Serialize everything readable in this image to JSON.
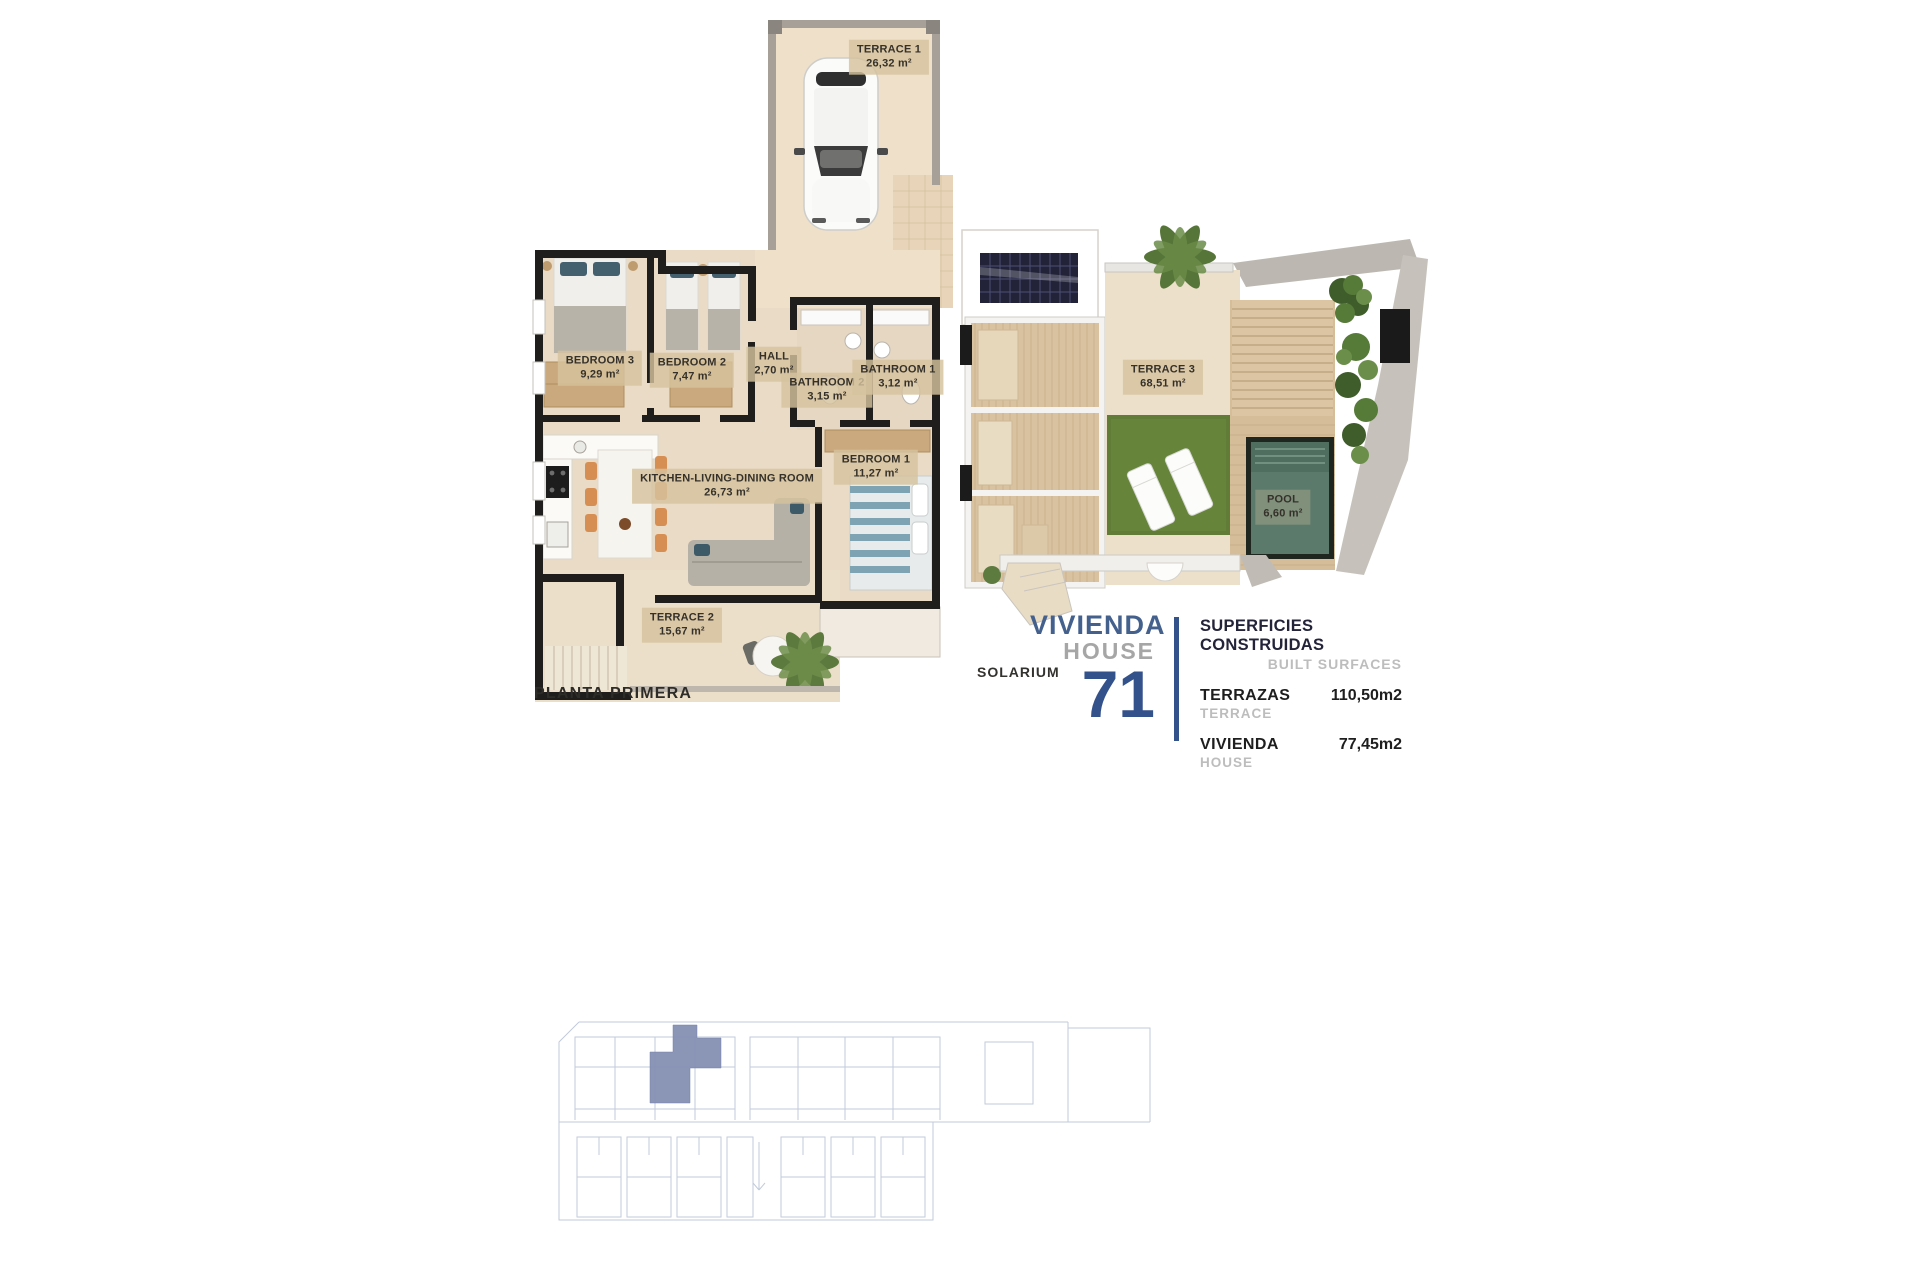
{
  "plan_left": {
    "title": "PLANTA PRIMERA",
    "rooms": [
      {
        "name": "TERRACE 1",
        "area": "26,32 m²"
      },
      {
        "name": "BEDROOM 3",
        "area": "9,29 m²"
      },
      {
        "name": "BEDROOM 2",
        "area": "7,47 m²"
      },
      {
        "name": "HALL",
        "area": "2,70  m²"
      },
      {
        "name": "BATHROOM 2",
        "area": "3,15 m²"
      },
      {
        "name": "BATHROOM 1",
        "area": "3,12 m²"
      },
      {
        "name": "BEDROOM 1",
        "area": "11,27 m²"
      },
      {
        "name": "KITCHEN-LIVING-DINING ROOM",
        "area": "26,73 m²"
      },
      {
        "name": "TERRACE 2",
        "area": "15,67 m²"
      }
    ]
  },
  "plan_right": {
    "title": "SOLARIUM",
    "rooms": [
      {
        "name": "TERRACE 3",
        "area": "68,51 m²"
      },
      {
        "name": "POOL",
        "area": "6,60 m²"
      }
    ]
  },
  "unit": {
    "vivienda_label": "VIVIENDA",
    "house_label": "HOUSE",
    "number": "71"
  },
  "surfaces": {
    "title_es": "SUPERFICIES CONSTRUIDAS",
    "title_en": "BUILT SURFACES",
    "rows": [
      {
        "label_es": "TERRAZAS",
        "label_en": "TERRACE",
        "value": "110,50m2"
      },
      {
        "label_es": "VIVIENDA",
        "label_en": "HOUSE",
        "value": "77,45m2"
      }
    ]
  },
  "colors": {
    "accent_blue": "#44618e",
    "number_blue": "#33518a",
    "muted_gray": "#bdbdbd",
    "wall_black": "#1f1e1c",
    "floor_beige": "#e9dbc5",
    "label_tan": "#d5c29e",
    "grass_green": "#617c37",
    "pool_teal": "#5c7a6c",
    "site_highlight": "#8590b3",
    "site_line": "#c2cbdb"
  }
}
